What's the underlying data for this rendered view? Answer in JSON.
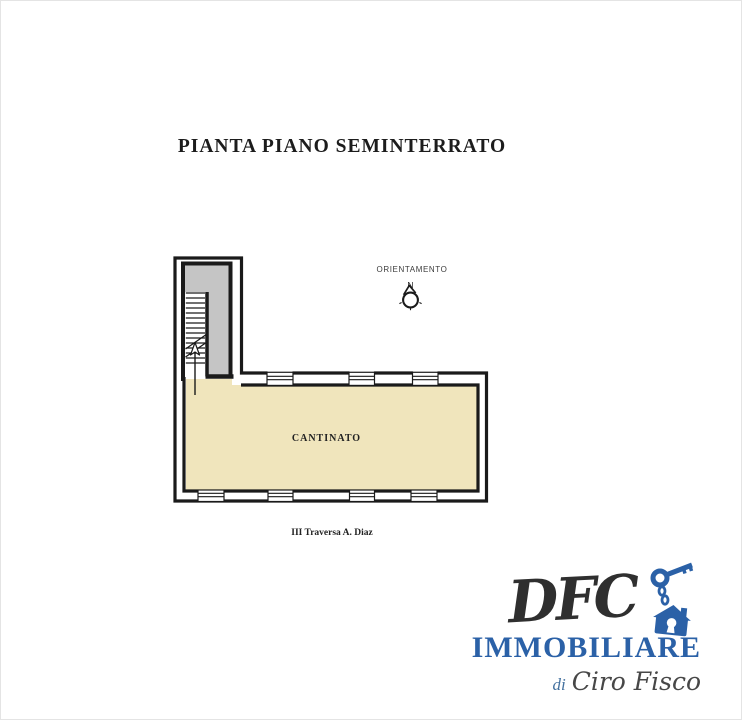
{
  "page": {
    "title": "PIANTA PIANO SEMINTERRATO"
  },
  "plan": {
    "orientation": {
      "label": "ORIENTAMENTO",
      "north": "N"
    },
    "room_label": "CANTINATO",
    "street_label": "III Traversa A. Diaz",
    "colors": {
      "room_fill": "#f0e5bc",
      "stairwell_fill": "#c5c5c5",
      "wall": "#1a1a1a"
    }
  },
  "logo": {
    "name": "DFC",
    "subtitle": "IMMOBILIARE",
    "owner_prefix": "di",
    "owner": "Ciro Fisco",
    "colors": {
      "blue": "#2b61a7",
      "script_dark": "#474747"
    }
  }
}
